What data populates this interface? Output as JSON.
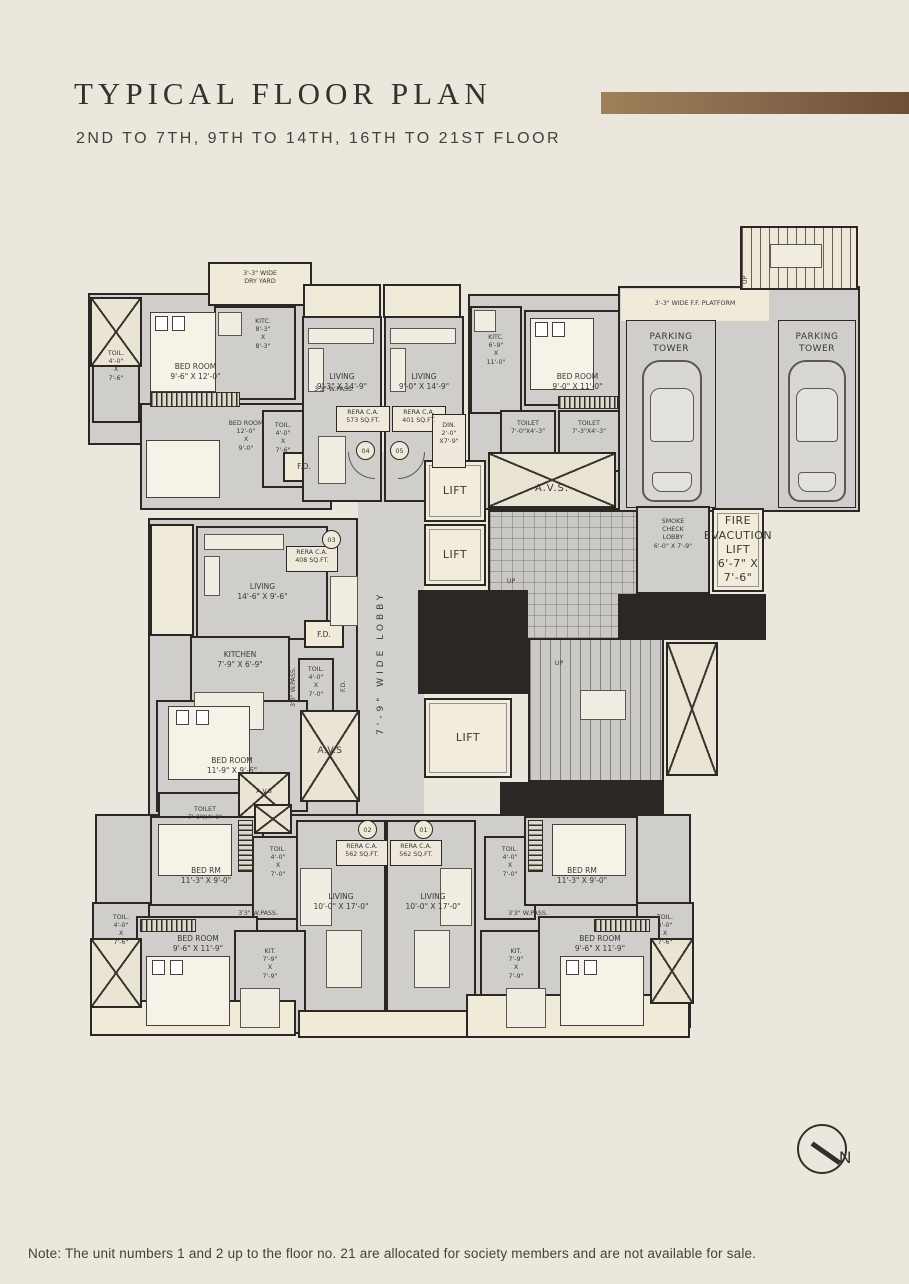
{
  "header": {
    "title": "TYPICAL FLOOR PLAN",
    "subtitle": "2ND TO 7TH, 9TH TO 14TH, 16TH TO 21ST FLOOR"
  },
  "footer": {
    "note": "Note: The unit numbers 1 and 2 up to the floor no. 21 are allocated for society members and are not available for sale."
  },
  "compass": {
    "north": "N"
  },
  "colors": {
    "page_background": "#ece7dc",
    "floor_gray": "#d0cfcc",
    "wall_dark": "#2a2724",
    "cream": "#f0ead9",
    "accent_bar_brown": "#86664a",
    "text": "#3b3834"
  },
  "plan": {
    "labels": {
      "dry_yard": "3'-3\" WIDE\nDRY YARD",
      "kitc_8_3": "KITC.\n8'-3\"\nX\n8'-3\"",
      "toil_4_0_7_6": "TOIL.\n4'-0\"\nX\n7'-6\"",
      "bed_9_6_12_0": "BED ROOM\n9'-6\" X 12'-0\"",
      "wpass": "3'3\" W.PASS.",
      "bed_12_0_9_0": "BED ROOM\n12'-0\"\nX\n9'-0\"",
      "fd": "F.D.",
      "living_9_3": "LIVING\n9'-3\" X 14'-9\"",
      "rera_573": "RERA C.A.\n573 SQ.FT.",
      "unit_04": "04",
      "living_9_0": "LIVING\n9'-0\" X 14'-9\"",
      "rera_401": "RERA C.A.\n401 SQ.FT.",
      "unit_05": "05",
      "din": "DIN.\n2'-0\"\nX7'-9\"",
      "kitc_6_9": "KITC.\n6'-9\"\nX\n11'-0\"",
      "toilet_7_0_4_3": "TOILET\n7'-0\"X4'-3\"",
      "toilet_7_3_4_3": "TOILET\n7'-3\"X4'-3\"",
      "bed_9_0_11_0": "BED ROOM\n9'-0\" X 11'-0\"",
      "ff_platform": "3'-3\" WIDE  F.F.  PLATFORM",
      "up": "UP",
      "parking": "PARKING\nTOWER",
      "lift": "LIFT",
      "avs_dots": "A.V.S.",
      "smoke_lobby": "SMOKE\nCHECK\nLOBBY\n6'-0\" X 7'-9\"",
      "fire_lift": "FIRE\nEVACUTION\nLIFT\n6'-7\" X 7'-6\"",
      "lobby": "7'-9\"  WIDE  LOBBY",
      "rera_408": "RERA C.A.\n408 SQ.FT.",
      "unit_03": "03",
      "living_14_6": "LIVING\n14'-6\" X 9'-6\"",
      "kitchen_7_9": "KITCHEN\n7'-9\" X 6'-9\"",
      "toil_4_0_7_0": "TOIL.\n4'-0\"\nX\n7'-0\"",
      "bed_11_9": "BED ROOM\n11'-9\" X 9'-6\"",
      "avs": "A.V.S",
      "toilet_7_0_4_0": "TOILET\n7'-0\"X4'-0\"",
      "bed_rm_11_3": "BED RM\n11'-3\" X 9'-0\"",
      "rera_562": "RERA C.A.\n562 SQ.FT.",
      "unit_02": "02",
      "unit_01": "01",
      "living_10_17": "LIVING\n10'-0\" X 17'-0\"",
      "bed_9_6_11_9": "BED ROOM\n9'-6\" X 11'-9\"",
      "kit_7_9": "KIT.\n7'-9\"\nX\n7'-9\""
    }
  }
}
